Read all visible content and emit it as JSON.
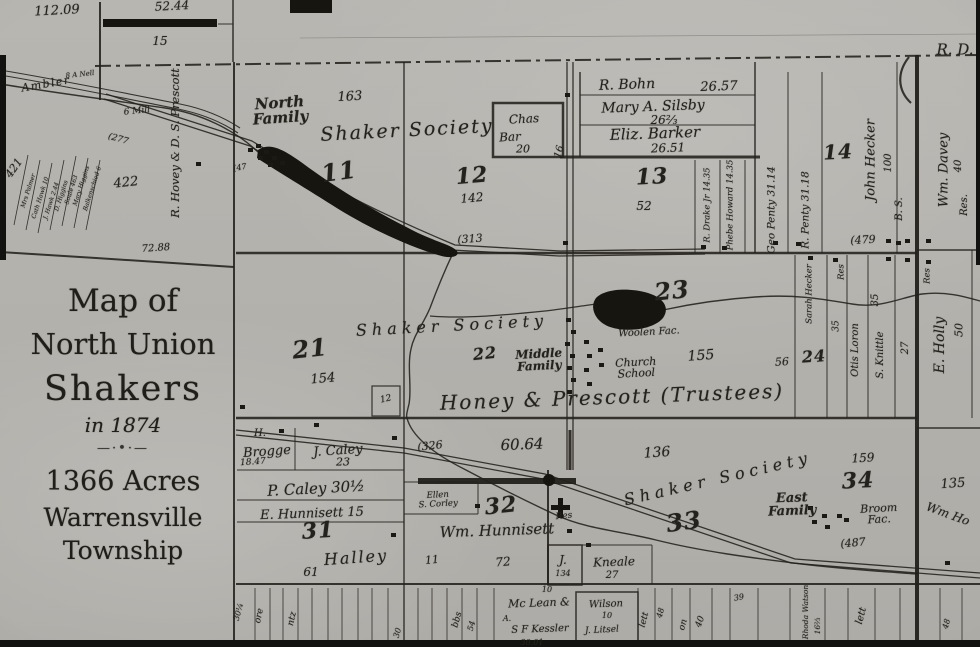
{
  "meta": {
    "subject": "Map of North Union Shakers in 1874"
  },
  "colors": {
    "paper": "#b5b3ae",
    "ink": "#24221c",
    "dark_feature": "#181611"
  },
  "title_block": {
    "l1": "Map of",
    "l2": "North Union",
    "l3": "Shakers",
    "l4": "in 1874",
    "ornament": "—·•·—",
    "l5": "1366 Acres",
    "l6": "Warrensville",
    "l7": "Township"
  },
  "labels": [
    {
      "name": "acreage-112-09",
      "text": "112.09",
      "x": 57,
      "y": 11,
      "fs": 13,
      "rot": -3
    },
    {
      "name": "acreage-52-44",
      "text": "52.44",
      "x": 172,
      "y": 6,
      "fs": 12,
      "rot": -3
    },
    {
      "name": "parcel-15",
      "text": "15",
      "x": 160,
      "y": 41,
      "fs": 12,
      "rot": 0
    },
    {
      "name": "road-r-d",
      "text": "R. D.",
      "x": 955,
      "y": 50,
      "fs": 15,
      "rot": 0
    },
    {
      "name": "ambler-road",
      "text": "Ambler",
      "x": 46,
      "y": 84,
      "fs": 11,
      "rot": -10,
      "ls": 1.5
    },
    {
      "name": "a-nell",
      "text": "8 A Nell",
      "x": 80,
      "y": 75,
      "fs": 7,
      "rot": -6
    },
    {
      "name": "grist-mill",
      "text": "6 Mill",
      "x": 137,
      "y": 112,
      "fs": 9,
      "rot": -6
    },
    {
      "name": "road-277",
      "text": "(277",
      "x": 118,
      "y": 140,
      "fs": 9,
      "rot": 16
    },
    {
      "name": "hovey-prescott",
      "text": "R. Hovey & D. S. Prescott",
      "x": 176,
      "y": 143,
      "fs": 11.5,
      "rot": -90
    },
    {
      "name": "acreage-422",
      "text": "422",
      "x": 126,
      "y": 183,
      "fs": 13,
      "rot": -6
    },
    {
      "name": "acreage-72-88",
      "text": "72.88",
      "x": 156,
      "y": 249,
      "fs": 10,
      "rot": -4
    },
    {
      "name": "acreage-421",
      "text": "421",
      "x": 14,
      "y": 168,
      "fs": 11,
      "rot": -55
    },
    {
      "name": "parcel-mrs-palmer",
      "text": "Mrs Palmer",
      "x": 29,
      "y": 191,
      "fs": 6,
      "rot": -72
    },
    {
      "name": "parcel-cath-hawk",
      "text": "Cath Hawk 10",
      "x": 41,
      "y": 198,
      "fs": 6,
      "rot": -72
    },
    {
      "name": "parcel-j-hawk",
      "text": "J. Hawk 2.44",
      "x": 52,
      "y": 201,
      "fs": 6,
      "rot": -72
    },
    {
      "name": "parcel-d-higgins",
      "text": "D. Higgins",
      "x": 62,
      "y": 196,
      "fs": 6,
      "rot": -72
    },
    {
      "name": "parcel-soule",
      "text": "Soule 463",
      "x": 72,
      "y": 190,
      "fs": 6,
      "rot": -72
    },
    {
      "name": "parcel-mary-higgins",
      "text": "Mary Higgins",
      "x": 82,
      "y": 186,
      "fs": 6,
      "rot": -72
    },
    {
      "name": "parcel-balkenschied",
      "text": "Balkenschied 6",
      "x": 93,
      "y": 189,
      "fs": 6,
      "rot": -72
    },
    {
      "name": "parcel-47",
      "text": "(47",
      "x": 240,
      "y": 168,
      "fs": 8,
      "rot": -10
    },
    {
      "name": "north-family",
      "text": "North\nFamily",
      "x": 280,
      "y": 111,
      "fs": 15,
      "rot": -4,
      "cls": "name"
    },
    {
      "name": "acreage-163",
      "text": "163",
      "x": 350,
      "y": 97,
      "fs": 13,
      "rot": -3
    },
    {
      "name": "shaker-society-north",
      "text": "Shaker Society",
      "x": 407,
      "y": 131,
      "fs": 19,
      "rot": -3,
      "ls": 2
    },
    {
      "name": "section-11",
      "text": "11",
      "x": 339,
      "y": 172,
      "fs": 24,
      "rot": -8,
      "cls": "big"
    },
    {
      "name": "chas-bar-1",
      "text": "Chas",
      "x": 524,
      "y": 119,
      "fs": 12,
      "rot": -3
    },
    {
      "name": "chas-bar-2",
      "text": "Bar",
      "x": 510,
      "y": 137,
      "fs": 12,
      "rot": -3
    },
    {
      "name": "chas-bar-acreage",
      "text": "20",
      "x": 523,
      "y": 149,
      "fs": 11,
      "rot": 0
    },
    {
      "name": "section-12",
      "text": "12",
      "x": 472,
      "y": 176,
      "fs": 22,
      "rot": -5,
      "cls": "big"
    },
    {
      "name": "acreage-142",
      "text": "142",
      "x": 472,
      "y": 198,
      "fs": 12,
      "rot": -5
    },
    {
      "name": "road-313",
      "text": "(313",
      "x": 470,
      "y": 239,
      "fs": 11,
      "rot": -4
    },
    {
      "name": "road-16",
      "text": "16",
      "x": 560,
      "y": 152,
      "fs": 10,
      "rot": -75
    },
    {
      "name": "parcel-r-bohn",
      "text": "R. Bohn",
      "x": 627,
      "y": 85,
      "fs": 14,
      "rot": -2
    },
    {
      "name": "r-bohn-acreage",
      "text": "26.57",
      "x": 719,
      "y": 87,
      "fs": 13,
      "rot": -2
    },
    {
      "name": "parcel-silsby",
      "text": "Mary A. Silsby",
      "x": 653,
      "y": 107,
      "fs": 14,
      "rot": -2
    },
    {
      "name": "silsby-acreage",
      "text": "26⅔",
      "x": 664,
      "y": 120,
      "fs": 12,
      "rot": 0
    },
    {
      "name": "parcel-barker",
      "text": "Eliz. Barker",
      "x": 655,
      "y": 134,
      "fs": 15,
      "rot": -2
    },
    {
      "name": "barker-acreage",
      "text": "26.51",
      "x": 668,
      "y": 148,
      "fs": 12,
      "rot": -2
    },
    {
      "name": "section-13",
      "text": "13",
      "x": 652,
      "y": 177,
      "fs": 22,
      "rot": -3,
      "cls": "big"
    },
    {
      "name": "acreage-52",
      "text": "52",
      "x": 644,
      "y": 206,
      "fs": 12,
      "rot": 0
    },
    {
      "name": "parcel-drake",
      "text": "R. Drake Jr 14.35",
      "x": 708,
      "y": 205,
      "fs": 8.5,
      "rot": -90
    },
    {
      "name": "parcel-phebe-howard",
      "text": "Phebe Howard 14.35",
      "x": 731,
      "y": 205,
      "fs": 8.5,
      "rot": -90
    },
    {
      "name": "parcel-geo-penty",
      "text": "Geo Penty 31.14",
      "x": 772,
      "y": 210,
      "fs": 10.5,
      "rot": -90
    },
    {
      "name": "parcel-r-penty",
      "text": "R. Penty 31.18",
      "x": 806,
      "y": 210,
      "fs": 10.5,
      "rot": -90
    },
    {
      "name": "section-14",
      "text": "14",
      "x": 838,
      "y": 152,
      "fs": 20,
      "rot": -3,
      "cls": "big"
    },
    {
      "name": "parcel-john-hecker",
      "text": "John Hecker",
      "x": 871,
      "y": 160,
      "fs": 13,
      "rot": -90
    },
    {
      "name": "hecker-acreage",
      "text": "100",
      "x": 889,
      "y": 163,
      "fs": 10,
      "rot": -90
    },
    {
      "name": "parcel-b-s",
      "text": "B. S.",
      "x": 900,
      "y": 209,
      "fs": 10,
      "rot": -90
    },
    {
      "name": "road-479",
      "text": "(479",
      "x": 863,
      "y": 240,
      "fs": 11,
      "rot": -3
    },
    {
      "name": "parcel-wm-davey",
      "text": "Wm. Davey",
      "x": 944,
      "y": 170,
      "fs": 13,
      "rot": -90
    },
    {
      "name": "davey-acreage",
      "text": "40",
      "x": 959,
      "y": 166,
      "fs": 10,
      "rot": -90
    },
    {
      "name": "davey-res",
      "text": "Res.",
      "x": 965,
      "y": 205,
      "fs": 10,
      "rot": -90
    },
    {
      "name": "section-21",
      "text": "21",
      "x": 310,
      "y": 349,
      "fs": 24,
      "rot": -6,
      "cls": "big"
    },
    {
      "name": "acreage-154",
      "text": "154",
      "x": 323,
      "y": 379,
      "fs": 13,
      "rot": -5
    },
    {
      "name": "lot-12",
      "text": "12",
      "x": 386,
      "y": 400,
      "fs": 9,
      "rot": -12
    },
    {
      "name": "shaker-society-mid",
      "text": "Shaker Society",
      "x": 452,
      "y": 326,
      "fs": 16,
      "rot": -3,
      "ls": 5
    },
    {
      "name": "section-22",
      "text": "22",
      "x": 485,
      "y": 354,
      "fs": 16,
      "rot": -6,
      "cls": "big"
    },
    {
      "name": "middle-family",
      "text": "Middle\nFamily",
      "x": 539,
      "y": 360,
      "fs": 12,
      "rot": -3,
      "cls": "name"
    },
    {
      "name": "honey-prescott-trustees",
      "text": "Honey & Prescott (Trustees)",
      "x": 612,
      "y": 397,
      "fs": 20,
      "rot": -2,
      "ls": 2
    },
    {
      "name": "section-23",
      "text": "23",
      "x": 672,
      "y": 291,
      "fs": 24,
      "rot": -6,
      "cls": "big"
    },
    {
      "name": "acreage-155",
      "text": "155",
      "x": 701,
      "y": 356,
      "fs": 14,
      "rot": -4
    },
    {
      "name": "woolen-factory",
      "text": "Woolen Fac.",
      "x": 649,
      "y": 333,
      "fs": 10,
      "rot": -3
    },
    {
      "name": "church-school",
      "text": "Church\nSchool",
      "x": 636,
      "y": 368,
      "fs": 11,
      "rot": -3
    },
    {
      "name": "acreage-56",
      "text": "56",
      "x": 782,
      "y": 362,
      "fs": 11,
      "rot": -3
    },
    {
      "name": "section-24",
      "text": "24",
      "x": 814,
      "y": 357,
      "fs": 16,
      "rot": -4,
      "cls": "big"
    },
    {
      "name": "parcel-sarah-hecker",
      "text": "Sarah Hecker",
      "x": 810,
      "y": 294,
      "fs": 8.5,
      "rot": -90
    },
    {
      "name": "sarah-hecker-acreage",
      "text": "35",
      "x": 837,
      "y": 326,
      "fs": 9,
      "rot": -90
    },
    {
      "name": "res-sarah",
      "text": "Res",
      "x": 842,
      "y": 272,
      "fs": 8.5,
      "rot": -90
    },
    {
      "name": "parcel-otis-loron",
      "text": "Otis Loron",
      "x": 856,
      "y": 350,
      "fs": 10,
      "rot": -90
    },
    {
      "name": "acreage-35b",
      "text": "35",
      "x": 876,
      "y": 300,
      "fs": 10,
      "rot": -90
    },
    {
      "name": "parcel-s-knittle",
      "text": "S. Knittle",
      "x": 881,
      "y": 355,
      "fs": 10,
      "rot": -90
    },
    {
      "name": "acreage-27v",
      "text": "27",
      "x": 906,
      "y": 348,
      "fs": 10,
      "rot": -90
    },
    {
      "name": "parcel-e-holly",
      "text": "E. Holly",
      "x": 940,
      "y": 345,
      "fs": 14,
      "rot": -90
    },
    {
      "name": "e-holly-acreage",
      "text": "50",
      "x": 959,
      "y": 330,
      "fs": 11,
      "rot": -90
    },
    {
      "name": "res-e-holly",
      "text": "Res",
      "x": 928,
      "y": 276,
      "fs": 8.5,
      "rot": -90
    },
    {
      "name": "parcel-h-brogge-initial",
      "text": "H.",
      "x": 260,
      "y": 434,
      "fs": 10,
      "rot": 0
    },
    {
      "name": "parcel-brogge",
      "text": "Brogge",
      "x": 267,
      "y": 452,
      "fs": 13,
      "rot": -4
    },
    {
      "name": "brogge-acreage",
      "text": "18.47",
      "x": 253,
      "y": 463,
      "fs": 9,
      "rot": -4
    },
    {
      "name": "parcel-j-caley",
      "text": "J. Caley",
      "x": 338,
      "y": 451,
      "fs": 13,
      "rot": -4
    },
    {
      "name": "j-caley-acreage",
      "text": "23",
      "x": 343,
      "y": 462,
      "fs": 11,
      "rot": 0
    },
    {
      "name": "parcel-p-caley",
      "text": "P. Caley 30½",
      "x": 316,
      "y": 489,
      "fs": 15,
      "rot": -3
    },
    {
      "name": "parcel-e-hunnisett",
      "text": "E. Hunnisett 15",
      "x": 312,
      "y": 514,
      "fs": 13,
      "rot": -2
    },
    {
      "name": "section-31",
      "text": "31",
      "x": 318,
      "y": 531,
      "fs": 22,
      "rot": -4,
      "cls": "big"
    },
    {
      "name": "parcel-halley",
      "text": "Halley",
      "x": 356,
      "y": 558,
      "fs": 16,
      "rot": -4,
      "ls": 2
    },
    {
      "name": "acreage-61",
      "text": "61",
      "x": 311,
      "y": 572,
      "fs": 12,
      "rot": 0
    },
    {
      "name": "road-326",
      "text": "(326",
      "x": 430,
      "y": 446,
      "fs": 11,
      "rot": -6
    },
    {
      "name": "acreage-60-64",
      "text": "60.64",
      "x": 522,
      "y": 445,
      "fs": 15,
      "rot": -2
    },
    {
      "name": "parcel-ellen-corley",
      "text": "Ellen\nS. Corley",
      "x": 438,
      "y": 500,
      "fs": 8.5,
      "rot": -3
    },
    {
      "name": "section-32",
      "text": "32",
      "x": 501,
      "y": 506,
      "fs": 22,
      "rot": -6,
      "cls": "big"
    },
    {
      "name": "res-32",
      "text": "Res",
      "x": 564,
      "y": 517,
      "fs": 9,
      "rot": -6
    },
    {
      "name": "parcel-wm-hunnisett",
      "text": "Wm. Hunnisett",
      "x": 497,
      "y": 531,
      "fs": 15,
      "rot": -2
    },
    {
      "name": "acreage-11b",
      "text": "11",
      "x": 432,
      "y": 560,
      "fs": 11,
      "rot": -5
    },
    {
      "name": "acreage-72b",
      "text": "72",
      "x": 503,
      "y": 562,
      "fs": 12,
      "rot": -5
    },
    {
      "name": "parcel-kneale-j",
      "text": "J.",
      "x": 563,
      "y": 560,
      "fs": 12,
      "rot": 0
    },
    {
      "name": "kneale-j-acreage",
      "text": "134",
      "x": 563,
      "y": 574,
      "fs": 8,
      "rot": 0
    },
    {
      "name": "parcel-kneale",
      "text": "Kneale",
      "x": 614,
      "y": 562,
      "fs": 12,
      "rot": -2
    },
    {
      "name": "kneale-acreage",
      "text": "27",
      "x": 612,
      "y": 576,
      "fs": 10,
      "rot": 0
    },
    {
      "name": "acreage-136",
      "text": "136",
      "x": 657,
      "y": 453,
      "fs": 14,
      "rot": -4
    },
    {
      "name": "shaker-society-south",
      "text": "Shaker Society",
      "x": 718,
      "y": 479,
      "fs": 16,
      "rot": -13,
      "ls": 5
    },
    {
      "name": "section-33",
      "text": "33",
      "x": 684,
      "y": 522,
      "fs": 24,
      "rot": -8,
      "cls": "big"
    },
    {
      "name": "east-family",
      "text": "East\nFamily",
      "x": 792,
      "y": 505,
      "fs": 13,
      "rot": -2,
      "cls": "name"
    },
    {
      "name": "acreage-159",
      "text": "159",
      "x": 863,
      "y": 458,
      "fs": 12,
      "rot": -3
    },
    {
      "name": "section-34",
      "text": "34",
      "x": 858,
      "y": 481,
      "fs": 22,
      "rot": -3,
      "cls": "big"
    },
    {
      "name": "broom-factory",
      "text": "Broom\nFac.",
      "x": 879,
      "y": 514,
      "fs": 11,
      "rot": -3
    },
    {
      "name": "road-487",
      "text": "(487",
      "x": 853,
      "y": 543,
      "fs": 11,
      "rot": -5
    },
    {
      "name": "acreage-135",
      "text": "135",
      "x": 953,
      "y": 484,
      "fs": 13,
      "rot": -4
    },
    {
      "name": "parcel-wm-ho",
      "text": "Wm Ho",
      "x": 948,
      "y": 514,
      "fs": 12,
      "rot": 20
    },
    {
      "name": "bottom-30q",
      "text": "30¼",
      "x": 239,
      "y": 612,
      "fs": 8,
      "rot": -75
    },
    {
      "name": "bottom-ore",
      "text": "ore",
      "x": 260,
      "y": 616,
      "fs": 9,
      "rot": -78
    },
    {
      "name": "bottom-ntz",
      "text": "ntz",
      "x": 293,
      "y": 619,
      "fs": 9,
      "rot": -78
    },
    {
      "name": "bottom-30",
      "text": "30",
      "x": 398,
      "y": 633,
      "fs": 8,
      "rot": -75
    },
    {
      "name": "bottom-bbs",
      "text": "bbs",
      "x": 458,
      "y": 620,
      "fs": 9,
      "rot": -75
    },
    {
      "name": "bottom-54",
      "text": "54",
      "x": 472,
      "y": 626,
      "fs": 8,
      "rot": -75
    },
    {
      "name": "parcel-mclean",
      "text": "Mc Lean &",
      "x": 539,
      "y": 603,
      "fs": 11,
      "rot": -2
    },
    {
      "name": "mclean-10",
      "text": "10",
      "x": 547,
      "y": 590,
      "fs": 8,
      "rot": 0
    },
    {
      "name": "mclean-a",
      "text": "A.",
      "x": 507,
      "y": 619,
      "fs": 8,
      "rot": 0
    },
    {
      "name": "parcel-kessler",
      "text": "S F Kessler",
      "x": 540,
      "y": 630,
      "fs": 10,
      "rot": -2
    },
    {
      "name": "kessler-acreage",
      "text": "30.01",
      "x": 532,
      "y": 643,
      "fs": 8,
      "rot": 0
    },
    {
      "name": "parcel-wilson",
      "text": "Wilson",
      "x": 606,
      "y": 605,
      "fs": 10,
      "rot": -2
    },
    {
      "name": "wilson-10",
      "text": "10",
      "x": 607,
      "y": 616,
      "fs": 8,
      "rot": 0
    },
    {
      "name": "parcel-litsel",
      "text": "J. Litsel",
      "x": 602,
      "y": 631,
      "fs": 9,
      "rot": -3
    },
    {
      "name": "bottom-lett1",
      "text": "lett",
      "x": 645,
      "y": 620,
      "fs": 9,
      "rot": -75
    },
    {
      "name": "bottom-48a",
      "text": "48",
      "x": 661,
      "y": 613,
      "fs": 8,
      "rot": -75
    },
    {
      "name": "bottom-on",
      "text": "on",
      "x": 684,
      "y": 625,
      "fs": 9,
      "rot": -75
    },
    {
      "name": "bottom-40",
      "text": "40",
      "x": 701,
      "y": 622,
      "fs": 9,
      "rot": -70
    },
    {
      "name": "bottom-39",
      "text": "39",
      "x": 739,
      "y": 598,
      "fs": 8,
      "rot": -10
    },
    {
      "name": "parcel-rhoda-watson",
      "text": "Rhoda Watson",
      "x": 806,
      "y": 612,
      "fs": 7.5,
      "rot": -90
    },
    {
      "name": "rhoda-acreage",
      "text": "16⅔",
      "x": 818,
      "y": 626,
      "fs": 7.5,
      "rot": -90
    },
    {
      "name": "bottom-lett2",
      "text": "lett",
      "x": 862,
      "y": 616,
      "fs": 10,
      "rot": -75
    },
    {
      "name": "bottom-48b",
      "text": "48",
      "x": 947,
      "y": 624,
      "fs": 8,
      "rot": -75
    }
  ]
}
